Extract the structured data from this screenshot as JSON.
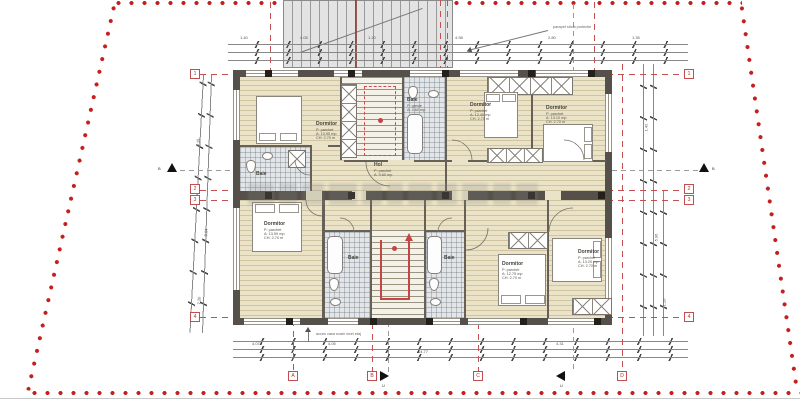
{
  "colors": {
    "boundary_red": "#c41f1f",
    "grid_red": "#c05050",
    "floor_beige": "#eae3c7",
    "wall_dark": "#55504a",
    "stair_arrow_red": "#c64444"
  },
  "grid_markers": {
    "left": [
      "1",
      "2",
      "3",
      "4"
    ],
    "right": [
      "1",
      "2",
      "3",
      "4"
    ],
    "bottom": [
      "A",
      "B",
      "C",
      "D"
    ]
  },
  "section_markers": {
    "mid_left": "B",
    "mid_right": "B",
    "bottom_left": "U",
    "bottom_right": "U"
  },
  "rooms": {
    "tl": {
      "name": "Dormitor",
      "lines": [
        "P: parchet",
        "A: 13.95 mp",
        "CH: 2.70 m"
      ]
    },
    "c1": {
      "name": "Dormitor",
      "lines": [
        "P: parchet",
        "A: 12.40 mp",
        "CH: 2.70 m"
      ]
    },
    "d1": {
      "name": "Dormitor",
      "lines": [
        "P: parchet",
        "A: 13.10 mp",
        "CH: 2.70 m"
      ]
    },
    "baie_mid": {
      "name": "Baie",
      "lines": [
        "P: gresie",
        "A: 4.60 mp"
      ]
    },
    "baie_tl": {
      "name": "Baie",
      "lines": [
        "P: gresie",
        "A: 4.20 mp"
      ]
    },
    "hol": {
      "name": "Hol",
      "lines": [
        "P: parchet",
        "A: 9.60 mp"
      ]
    },
    "bl": {
      "name": "Dormitor",
      "lines": [
        "P: parchet",
        "A: 13.50 mp",
        "CH: 2.70 m"
      ]
    },
    "baie_bl": {
      "name": "Baie",
      "lines": [
        "P: gresie",
        "A: 4.10 mp"
      ]
    },
    "baie_br": {
      "name": "Baie",
      "lines": [
        "P: gresie",
        "A: 3.80 mp"
      ]
    },
    "c2": {
      "name": "Dormitor",
      "lines": [
        "P: parchet",
        "A: 12.75 mp",
        "CH: 2.70 m"
      ]
    },
    "d2": {
      "name": "Dormitor",
      "lines": [
        "P: parchet",
        "A: 13.20 mp",
        "CH: 2.70 m"
      ]
    }
  },
  "dims": {
    "top": [
      "1.40",
      "4.05",
      "1.20",
      "4.98",
      "2.80",
      "1.35"
    ],
    "bottom": [
      "4.07",
      "4.05",
      "4.31",
      "14.77"
    ],
    "left": [
      "3.15",
      "8.64",
      "2.20"
    ],
    "right": [
      "1.42",
      "5.96",
      "1.10"
    ]
  },
  "notes": {
    "top": "parapet sticla protectie",
    "bottom": "acces casa scarii nivel etaj"
  }
}
